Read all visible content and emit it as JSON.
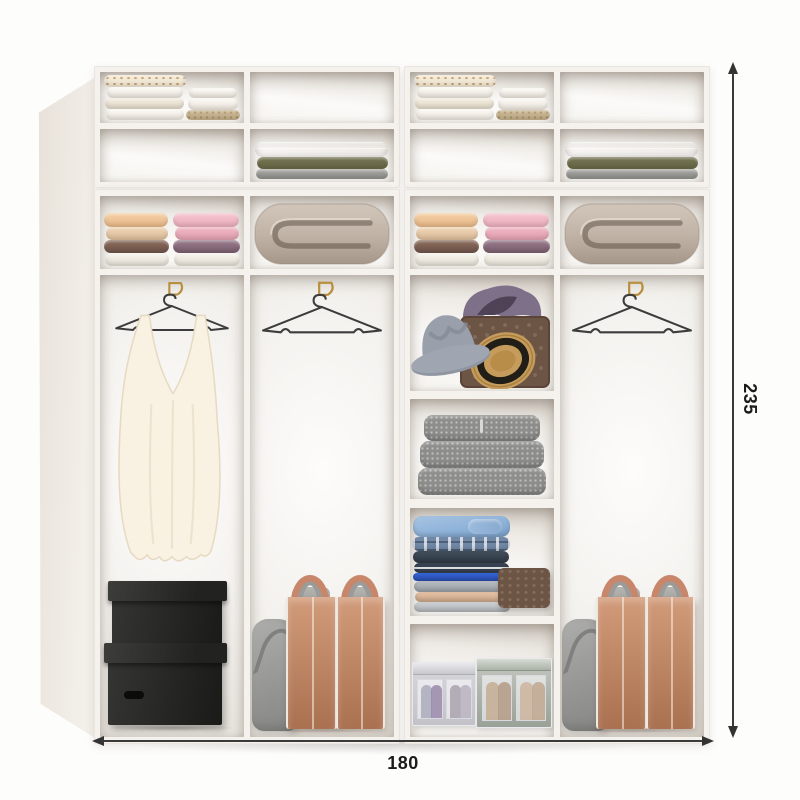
{
  "diagram": {
    "type": "wardrobe-interior-dimension-diagram",
    "dimension_labels": {
      "width": "180",
      "height": "235"
    },
    "colors": {
      "frame": "#f5f2ed",
      "interior_shadow": "#d8d2ca",
      "dimension_line": "#333333",
      "black_box": "#242422",
      "storage_bag_tan": "#bf8866",
      "soft_bag_gray": "#979795",
      "duvet_beige": "#c3b6a9",
      "towel_peach": "#f0c9a2",
      "towel_brown": "#7f6353",
      "towel_pink": "#f0b9c6",
      "towel_mauve": "#8d6f7e",
      "blanket_tan": "#b29878",
      "blanket_olive": "#6e6e4d",
      "blanket_gray": "#9b9b97",
      "sweater_gray": "#8d8d8b",
      "shirt_blue": "#8fb3d9",
      "hat_gray": "#9aa0ab",
      "hat_straw": "#c59c5c",
      "basket_brown": "#6d5546",
      "blouse_cream": "#f9f1e2",
      "hanger_wire": "#3c3c3c",
      "hook_gold": "#b78f3e"
    },
    "modules": [
      {
        "name": "left",
        "top_cabinet": [
          [
            "folded-knitwear-stack",
            "empty"
          ],
          [
            "empty",
            "folded-blankets"
          ]
        ],
        "shelf_row": [
          "towel-stacks",
          "rolled-duvet"
        ],
        "columns": [
          {
            "items": [
              "gold-hook",
              "wire-hanger",
              "white-blouse",
              "two-black-storage-boxes"
            ]
          },
          {
            "items": [
              "gold-hook",
              "empty-wire-hanger",
              "gray-fabric-bag",
              "two-tan-storage-bags"
            ]
          }
        ]
      },
      {
        "name": "right",
        "top_cabinet": [
          [
            "folded-knitwear-stack",
            "empty"
          ],
          [
            "empty",
            "folded-blankets"
          ]
        ],
        "shelf_row": [
          "towel-stacks",
          "rolled-duvet"
        ],
        "columns": [
          {
            "items": [
              "hats-and-wicker-basket",
              "gray-sweater-stack",
              "folded-shirt-stack",
              "wicker-box",
              "fabric-organizer-boxes"
            ]
          },
          {
            "items": [
              "gold-hook",
              "empty-wire-hanger",
              "gray-fabric-bag",
              "two-tan-storage-bags"
            ]
          }
        ]
      }
    ]
  }
}
